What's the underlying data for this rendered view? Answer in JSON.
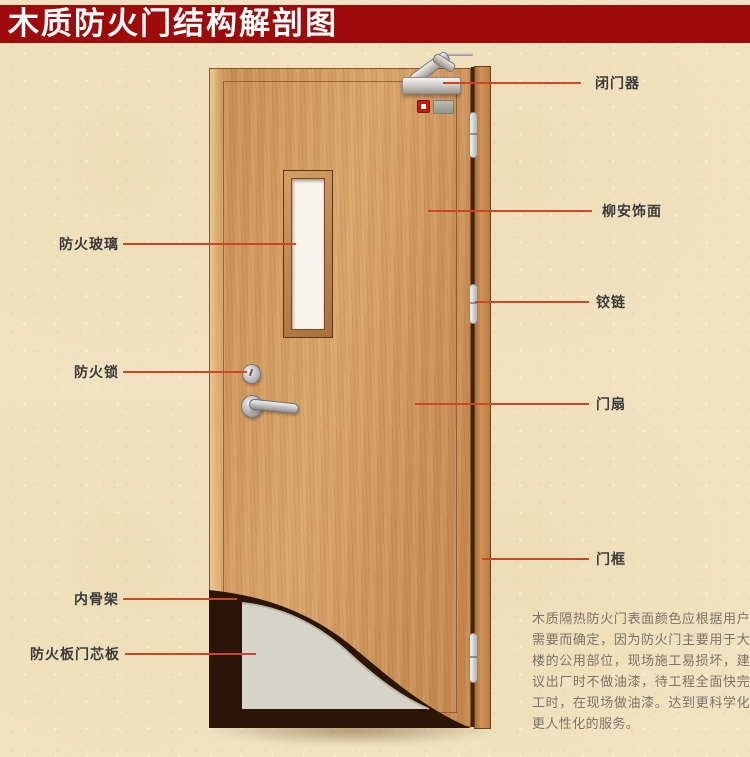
{
  "title": {
    "text": "木质防火门结构解剖图"
  },
  "diagram": {
    "left_labels": [
      {
        "text": "防火玻璃"
      },
      {
        "text": "防火锁"
      },
      {
        "text": "内骨架"
      },
      {
        "text": "防火板门芯板"
      }
    ],
    "right_labels": [
      {
        "text": "闭门器"
      },
      {
        "text": "柳安饰面"
      },
      {
        "text": "铰链"
      },
      {
        "text": "门扇"
      },
      {
        "text": "门框"
      }
    ],
    "description": "木质隔热防火门表面颜色应根据用户需要而确定，因为防火门主要用于大楼的公用部位，现场施工易损坏，建议出厂时不做油漆，待工程全面快完工时，在现场做油漆。达到更科学化更人性化的服务。"
  },
  "colors": {
    "title_bar": "#9d0b0b",
    "title_text": "#ffffff",
    "lead_line": "#cf4526",
    "background": "#f1e3c1",
    "door_wood": "#cd9257",
    "door_frame": "#b97c42",
    "core_board": "#d6d3c8",
    "skeleton_dark": "#2c1406",
    "glass": "#f8f5ea",
    "hardware_silver": "#c0c0c0",
    "alarm_red": "#c41b12"
  }
}
